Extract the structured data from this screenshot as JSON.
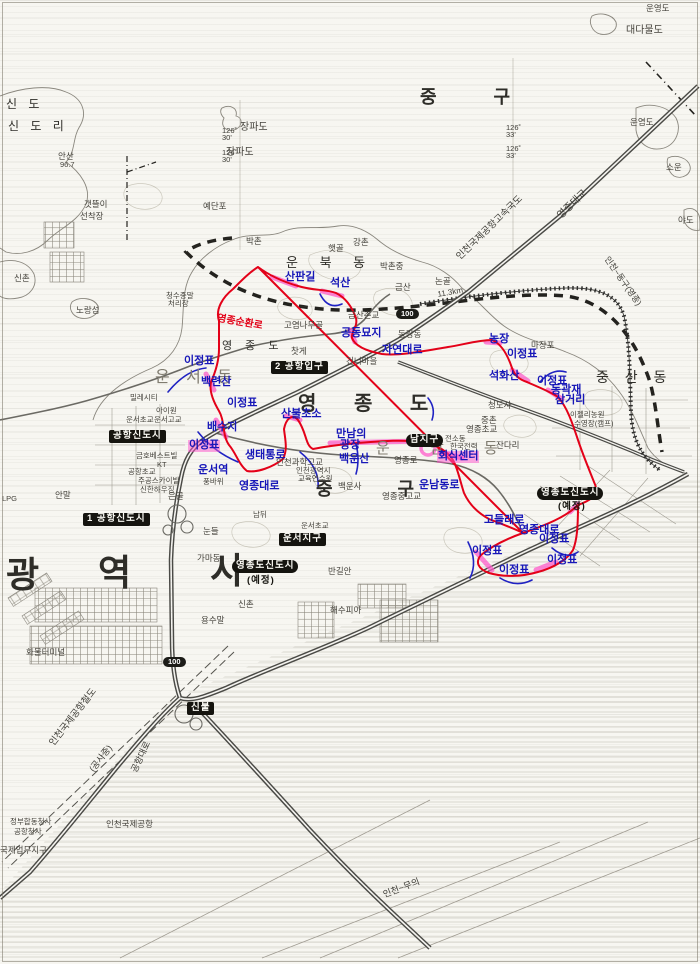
{
  "districts": [
    {
      "text": "중 구",
      "x": 420,
      "y": 88,
      "size": 18,
      "ls": 26,
      "bold": 1
    },
    {
      "text": "운 북 동",
      "x": 286,
      "y": 256,
      "size": 13,
      "ls": 9
    },
    {
      "text": "영 종 도",
      "x": 222,
      "y": 341,
      "size": 11,
      "ls": 5
    },
    {
      "text": "영 종 도",
      "x": 298,
      "y": 394,
      "size": 20,
      "ls": 16,
      "bold": 1
    },
    {
      "text": "운 서 동",
      "x": 155,
      "y": 370,
      "size": 16,
      "ls": 6,
      "light": 1
    },
    {
      "text": "운 남 동",
      "x": 376,
      "y": 441,
      "size": 15,
      "ls": 18,
      "light": 1
    },
    {
      "text": "중 산 동",
      "x": 596,
      "y": 370,
      "size": 14,
      "ls": 6
    },
    {
      "text": "중 구",
      "x": 316,
      "y": 480,
      "size": 18,
      "ls": 30,
      "bold": 1
    },
    {
      "text": "광",
      "x": 6,
      "y": 556,
      "size": 36,
      "bold": 1
    },
    {
      "text": "역",
      "x": 98,
      "y": 554,
      "size": 36,
      "bold": 1
    },
    {
      "text": "시",
      "x": 210,
      "y": 552,
      "size": 36,
      "bold": 1
    },
    {
      "text": "신 도",
      "x": 6,
      "y": 98,
      "size": 12,
      "ls": 4
    },
    {
      "text": "신 도 리",
      "x": 8,
      "y": 120,
      "size": 12,
      "ls": 4
    }
  ],
  "blue_labels": [
    {
      "text": "산판길",
      "x": 285,
      "y": 272
    },
    {
      "text": "석산",
      "x": 330,
      "y": 278
    },
    {
      "text": "공동묘지",
      "x": 341,
      "y": 328
    },
    {
      "text": "자연대로",
      "x": 382,
      "y": 345
    },
    {
      "text": "농장",
      "x": 489,
      "y": 334
    },
    {
      "text": "이정표",
      "x": 507,
      "y": 349
    },
    {
      "text": "석화산",
      "x": 489,
      "y": 371
    },
    {
      "text": "이정표",
      "x": 537,
      "y": 376
    },
    {
      "text": "동곽재",
      "x": 551,
      "y": 385
    },
    {
      "text": "삼거리",
      "x": 555,
      "y": 395
    },
    {
      "text": "이정표",
      "x": 184,
      "y": 356
    },
    {
      "text": "백련산",
      "x": 201,
      "y": 377
    },
    {
      "text": "이정표",
      "x": 227,
      "y": 398
    },
    {
      "text": "배수지",
      "x": 207,
      "y": 422
    },
    {
      "text": "이정표",
      "x": 188,
      "y": 440,
      "hl": 1
    },
    {
      "text": "생태통로",
      "x": 245,
      "y": 450
    },
    {
      "text": "운서역",
      "x": 198,
      "y": 465
    },
    {
      "text": "영종대로",
      "x": 239,
      "y": 481
    },
    {
      "text": "산불초소",
      "x": 281,
      "y": 409
    },
    {
      "text": "만남의",
      "x": 336,
      "y": 429
    },
    {
      "text": "광장",
      "x": 340,
      "y": 440
    },
    {
      "text": "백운산",
      "x": 339,
      "y": 454
    },
    {
      "text": "회식센터",
      "x": 437,
      "y": 451,
      "hl": 1
    },
    {
      "text": "운남동로",
      "x": 419,
      "y": 480
    },
    {
      "text": "고들래로",
      "x": 484,
      "y": 515
    },
    {
      "text": "영종대로",
      "x": 519,
      "y": 525
    },
    {
      "text": "이정표",
      "x": 539,
      "y": 534
    },
    {
      "text": "이정표",
      "x": 472,
      "y": 546
    },
    {
      "text": "이정표",
      "x": 547,
      "y": 555
    },
    {
      "text": "이정표",
      "x": 499,
      "y": 565
    }
  ],
  "red_labels": [
    {
      "text": "영종순환로",
      "x": 218,
      "y": 314,
      "rot": 10
    }
  ],
  "place_labels": [
    {
      "text": "대다물도",
      "x": 626,
      "y": 26,
      "size": 10
    },
    {
      "text": "운염도",
      "x": 630,
      "y": 118
    },
    {
      "text": "소운",
      "x": 666,
      "y": 163
    },
    {
      "text": "야도",
      "x": 678,
      "y": 216
    },
    {
      "text": "운영도",
      "x": 646,
      "y": 4
    },
    {
      "text": "장파도",
      "x": 240,
      "y": 123,
      "size": 10
    },
    {
      "text": "장파도",
      "x": 226,
      "y": 148,
      "size": 10
    },
    {
      "text": "예단포",
      "x": 203,
      "y": 202
    },
    {
      "text": "노랑섬",
      "x": 76,
      "y": 306
    },
    {
      "text": "갯뜰이",
      "x": 84,
      "y": 200
    },
    {
      "text": "선착장",
      "x": 80,
      "y": 212
    },
    {
      "text": "안산",
      "x": 58,
      "y": 152
    },
    {
      "text": "96.7",
      "x": 60,
      "y": 161,
      "size": 7.5
    },
    {
      "text": "신촌",
      "x": 14,
      "y": 274
    },
    {
      "text": "청수종말",
      "x": 166,
      "y": 292,
      "size": 7.5
    },
    {
      "text": "처리장",
      "x": 168,
      "y": 300,
      "size": 7.5
    },
    {
      "text": "박촌",
      "x": 246,
      "y": 237
    },
    {
      "text": "햇골",
      "x": 328,
      "y": 244
    },
    {
      "text": "강촌",
      "x": 353,
      "y": 238
    },
    {
      "text": "박촌중",
      "x": 380,
      "y": 262
    },
    {
      "text": "금산",
      "x": 395,
      "y": 283
    },
    {
      "text": "금산촌교",
      "x": 348,
      "y": 311
    },
    {
      "text": "논골",
      "x": 435,
      "y": 277
    },
    {
      "text": "마장포",
      "x": 531,
      "y": 341
    },
    {
      "text": "고염나무골",
      "x": 284,
      "y": 321
    },
    {
      "text": "찻게",
      "x": 291,
      "y": 347
    },
    {
      "text": "건너마을",
      "x": 346,
      "y": 357
    },
    {
      "text": "동강동",
      "x": 398,
      "y": 330
    },
    {
      "text": "중촌",
      "x": 481,
      "y": 416
    },
    {
      "text": "청도사",
      "x": 488,
      "y": 401
    },
    {
      "text": "영종초교",
      "x": 466,
      "y": 425
    },
    {
      "text": "이젤리농원",
      "x": 570,
      "y": 411,
      "size": 7.5
    },
    {
      "text": "수영장(캠프)",
      "x": 574,
      "y": 420,
      "size": 7.5
    },
    {
      "text": "전소동",
      "x": 445,
      "y": 435,
      "size": 7.5
    },
    {
      "text": "한국전력",
      "x": 450,
      "y": 443,
      "size": 7.5
    },
    {
      "text": "잔다리",
      "x": 496,
      "y": 441
    },
    {
      "text": "인천과학고교",
      "x": 276,
      "y": 458
    },
    {
      "text": "인천광역시",
      "x": 296,
      "y": 467,
      "size": 7.5
    },
    {
      "text": "교육연수원",
      "x": 298,
      "y": 475,
      "size": 7.5
    },
    {
      "text": "백운사",
      "x": 338,
      "y": 482
    },
    {
      "text": "영종로",
      "x": 394,
      "y": 456
    },
    {
      "text": "영종중고교",
      "x": 382,
      "y": 492
    },
    {
      "text": "운서초교",
      "x": 126,
      "y": 416,
      "size": 7.5
    },
    {
      "text": "운서고교",
      "x": 154,
      "y": 416,
      "size": 7.5
    },
    {
      "text": "밀레시티",
      "x": 130,
      "y": 394,
      "size": 7.5
    },
    {
      "text": "아이원",
      "x": 156,
      "y": 407,
      "size": 7.5
    },
    {
      "text": "금호베스트빌",
      "x": 136,
      "y": 452,
      "size": 7.5
    },
    {
      "text": "KT",
      "x": 157,
      "y": 461,
      "size": 7.5
    },
    {
      "text": "공항초교",
      "x": 128,
      "y": 468,
      "size": 7.5
    },
    {
      "text": "주공스카이빌",
      "x": 138,
      "y": 477,
      "size": 7.5
    },
    {
      "text": "신한하우징",
      "x": 140,
      "y": 486,
      "size": 7.5
    },
    {
      "text": "은골",
      "x": 168,
      "y": 492
    },
    {
      "text": "풍바위",
      "x": 203,
      "y": 478,
      "size": 7.5
    },
    {
      "text": "안말",
      "x": 55,
      "y": 491
    },
    {
      "text": "LPG",
      "x": 2,
      "y": 495,
      "size": 7.5
    },
    {
      "text": "눈들",
      "x": 203,
      "y": 527
    },
    {
      "text": "가마동",
      "x": 197,
      "y": 554
    },
    {
      "text": "남뒤",
      "x": 253,
      "y": 511,
      "size": 7.5
    },
    {
      "text": "운서초교",
      "x": 301,
      "y": 522,
      "size": 7.5
    },
    {
      "text": "반길안",
      "x": 328,
      "y": 567
    },
    {
      "text": "신촌",
      "x": 238,
      "y": 600
    },
    {
      "text": "용수말",
      "x": 201,
      "y": 616
    },
    {
      "text": "해수피아",
      "x": 330,
      "y": 606
    },
    {
      "text": "화물터미널",
      "x": 26,
      "y": 648
    },
    {
      "text": "정부합동청사",
      "x": 10,
      "y": 818,
      "size": 7.5
    },
    {
      "text": "공항청사",
      "x": 14,
      "y": 828,
      "size": 7.5
    },
    {
      "text": "국제업무지구",
      "x": 0,
      "y": 846
    },
    {
      "text": "인천국제공항",
      "x": 106,
      "y": 820
    }
  ],
  "road_labels": [
    {
      "text": "인천국제공항고속국도",
      "x": 455,
      "y": 255,
      "rot": -44,
      "size": 9.5
    },
    {
      "text": "영종대교",
      "x": 556,
      "y": 214,
      "rot": -44,
      "size": 10
    },
    {
      "text": "공항대로",
      "x": 130,
      "y": 770,
      "rot": -65,
      "size": 9
    },
    {
      "text": "인천국제공항철도",
      "x": 48,
      "y": 742,
      "rot": -52,
      "size": 9.5
    },
    {
      "text": "(공사중)",
      "x": 88,
      "y": 768,
      "rot": -52,
      "size": 9
    },
    {
      "text": "인천~무의",
      "x": 382,
      "y": 891,
      "rot": -21,
      "size": 9
    },
    {
      "text": "인천~동구(영종)",
      "x": 610,
      "y": 255,
      "rot": 55,
      "size": 8.5
    },
    {
      "text": "11.3km",
      "x": 437,
      "y": 291,
      "rot": -10,
      "size": 8
    }
  ],
  "box_labels": [
    {
      "text": "공항신도시",
      "x": 109,
      "y": 430
    },
    {
      "text": "1 공항신도시",
      "x": 83,
      "y": 513
    },
    {
      "text": "2 공항입구",
      "x": 271,
      "y": 361
    },
    {
      "text": "운서지구",
      "x": 279,
      "y": 533
    },
    {
      "text": "남지구",
      "x": 406,
      "y": 434,
      "pill": 1
    },
    {
      "text": "영종도신도시",
      "x": 232,
      "y": 560,
      "pill": 1
    },
    {
      "text": "영종도신도시",
      "x": 537,
      "y": 487,
      "pill": 1
    },
    {
      "text": "신불",
      "x": 187,
      "y": 702
    }
  ],
  "sub_labels": [
    {
      "text": "(예정)",
      "x": 247,
      "y": 576
    },
    {
      "text": "(예정)",
      "x": 558,
      "y": 502
    }
  ],
  "badges": [
    {
      "text": "100",
      "x": 396,
      "y": 309
    },
    {
      "text": "100",
      "x": 163,
      "y": 657
    }
  ],
  "coord_labels": [
    {
      "deg": "126˚",
      "min": "33'",
      "x": 506,
      "y": 124
    },
    {
      "deg": "126˚",
      "min": "33'",
      "x": 506,
      "y": 145
    },
    {
      "deg": "126˚",
      "min": "30'",
      "x": 222,
      "y": 127
    },
    {
      "deg": "126˚",
      "min": "30'",
      "x": 222,
      "y": 149
    }
  ],
  "colors": {
    "route_red": "#e50018",
    "highlight_pink": "#ff5ccb",
    "annotation_blue": "#1717b8",
    "road_dark": "#4a4a46",
    "paper": "#f7f6f1"
  }
}
